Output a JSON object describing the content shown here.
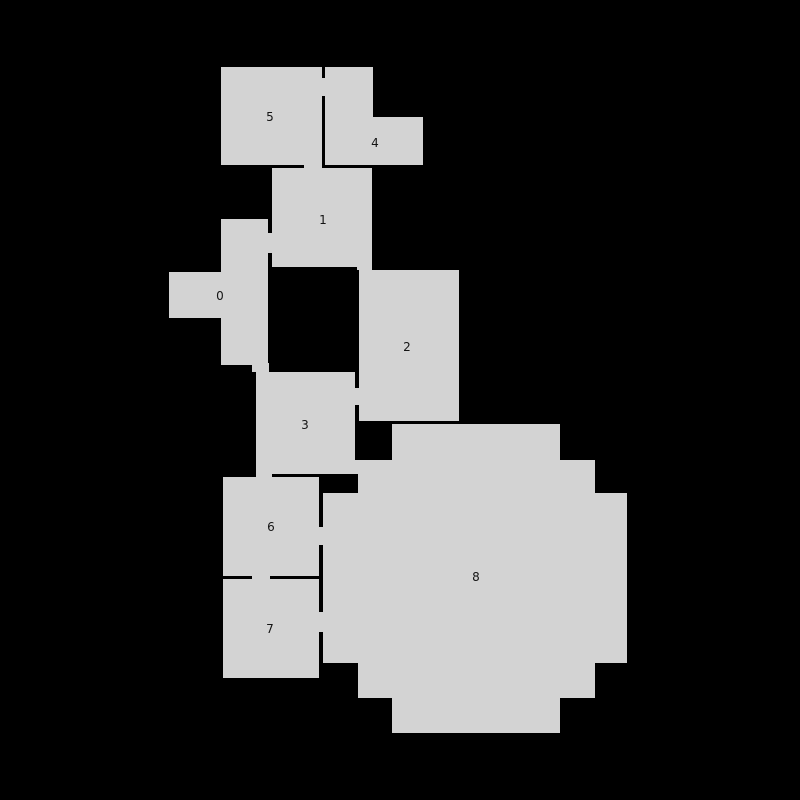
{
  "canvas": {
    "width": 800,
    "height": 800,
    "background": "#000000"
  },
  "map": {
    "room_fill": "#d3d3d3",
    "wall_color": "#000000",
    "label_color": "#141414",
    "rooms": [
      {
        "id": "0",
        "label": "0",
        "label_x": 220,
        "label_y": 296,
        "rects": [
          [
            221,
            219,
            47,
            146
          ],
          [
            169,
            272,
            52,
            46
          ]
        ]
      },
      {
        "id": "1",
        "label": "1",
        "label_x": 323,
        "label_y": 220,
        "rects": [
          [
            272,
            168,
            100,
            99
          ]
        ]
      },
      {
        "id": "2",
        "label": "2",
        "label_x": 407,
        "label_y": 347,
        "rects": [
          [
            359,
            270,
            100,
            151
          ]
        ]
      },
      {
        "id": "3",
        "label": "3",
        "label_x": 305,
        "label_y": 425,
        "rects": [
          [
            256,
            372,
            99,
            102
          ]
        ]
      },
      {
        "id": "4",
        "label": "4",
        "label_x": 375,
        "label_y": 143,
        "rects": [
          [
            324,
            67,
            49,
            98
          ],
          [
            373,
            117,
            50,
            48
          ]
        ]
      },
      {
        "id": "5",
        "label": "5",
        "label_x": 270,
        "label_y": 117,
        "rects": [
          [
            221,
            67,
            101,
            98
          ]
        ]
      },
      {
        "id": "6",
        "label": "6",
        "label_x": 271,
        "label_y": 527,
        "rects": [
          [
            223,
            477,
            96,
            99
          ]
        ]
      },
      {
        "id": "7",
        "label": "7",
        "label_x": 270,
        "label_y": 629,
        "rects": [
          [
            223,
            579,
            96,
            99
          ]
        ]
      },
      {
        "id": "8",
        "label": "8",
        "label_x": 476,
        "label_y": 577,
        "rects": [
          [
            392,
            424,
            168,
            36
          ],
          [
            358,
            460,
            237,
            33
          ],
          [
            323,
            493,
            304,
            170
          ],
          [
            358,
            663,
            237,
            35
          ],
          [
            392,
            698,
            168,
            35
          ]
        ]
      }
    ],
    "walls": [
      [
        322,
        67,
        3,
        98
      ],
      [
        272,
        165,
        101,
        3
      ],
      [
        268,
        219,
        4,
        48
      ],
      [
        355,
        372,
        4,
        49
      ],
      [
        392,
        421,
        66,
        3
      ],
      [
        223,
        576,
        96,
        3
      ],
      [
        319,
        477,
        4,
        201
      ]
    ],
    "doors": [
      [
        322,
        78,
        3,
        18
      ],
      [
        304,
        165,
        18,
        3
      ],
      [
        268,
        233,
        4,
        20
      ],
      [
        357,
        267,
        15,
        3
      ],
      [
        355,
        388,
        4,
        17
      ],
      [
        252,
        363,
        17,
        9
      ],
      [
        355,
        460,
        3,
        14
      ],
      [
        256,
        474,
        16,
        3
      ],
      [
        252,
        576,
        18,
        3
      ],
      [
        319,
        527,
        4,
        18
      ],
      [
        319,
        612,
        4,
        20
      ]
    ]
  }
}
